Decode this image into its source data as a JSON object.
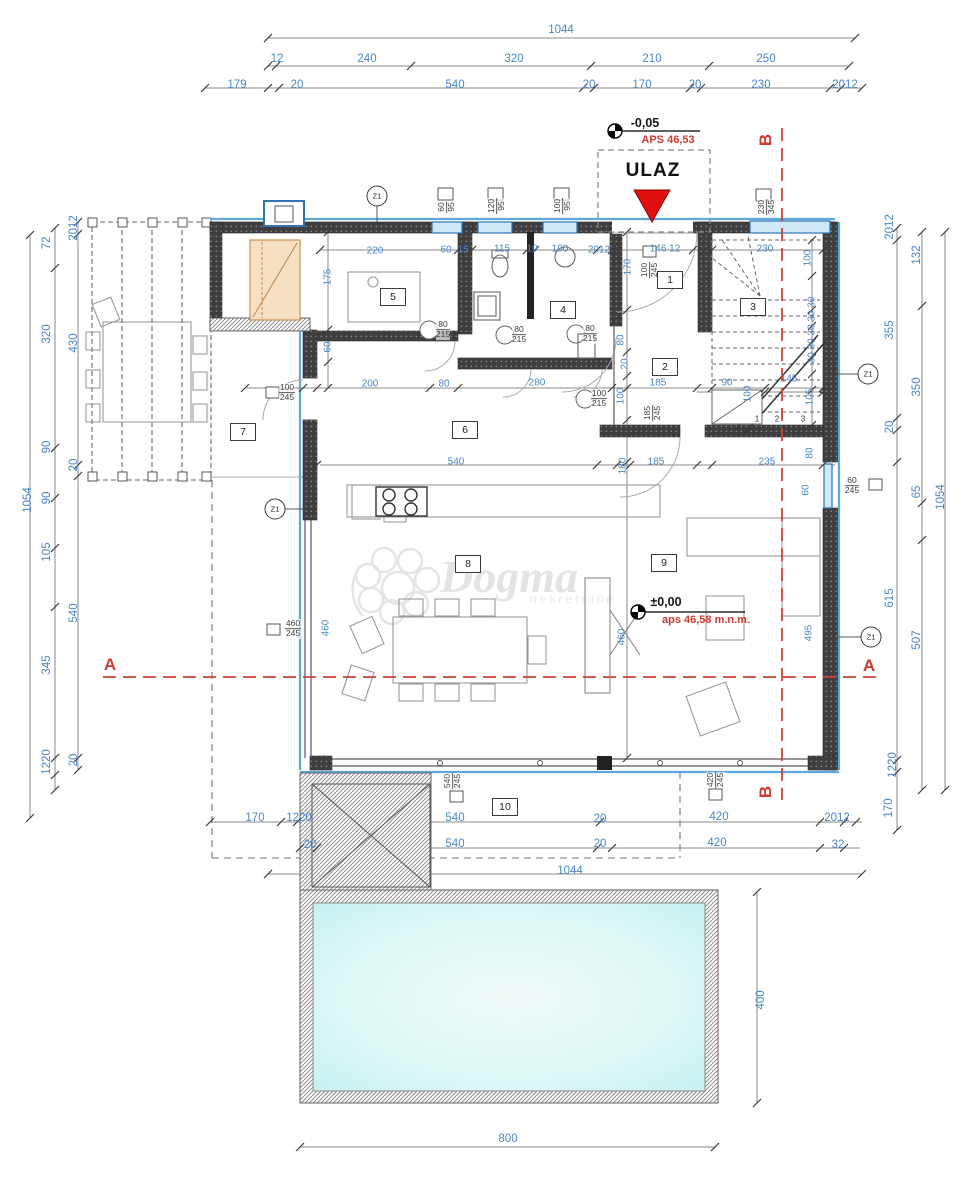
{
  "entrance": {
    "label": "ULAZ"
  },
  "watermark": {
    "name": "Dogma",
    "sub": "nekretnine"
  },
  "levels": {
    "entry_level": "-0,05",
    "entry_abs": "APS 46,53",
    "main_level": "±0,00",
    "main_abs": "aps 46,58 m.n.m."
  },
  "section_marks": [
    "A",
    "B"
  ],
  "colors": {
    "dim_blue": "#4a86c8",
    "accent_red": "#cf3a32",
    "glazing_blue": "#2e74b5",
    "pool_cyan": "#c4f2ef",
    "wood_tan": "#f6e0c2"
  },
  "rooms": [
    {
      "n": "1",
      "x": 670,
      "y": 280
    },
    {
      "n": "2",
      "x": 665,
      "y": 367
    },
    {
      "n": "3",
      "x": 753,
      "y": 307
    },
    {
      "n": "4",
      "x": 563,
      "y": 310
    },
    {
      "n": "5",
      "x": 393,
      "y": 297
    },
    {
      "n": "6",
      "x": 465,
      "y": 430
    },
    {
      "n": "7",
      "x": 243,
      "y": 432
    },
    {
      "n": "8",
      "x": 468,
      "y": 564
    },
    {
      "n": "9",
      "x": 664,
      "y": 563
    },
    {
      "n": "10",
      "x": 505,
      "y": 807
    }
  ],
  "zmarks": [
    {
      "t": "Z1",
      "x": 377,
      "y": 196
    },
    {
      "t": "Z1",
      "x": 275,
      "y": 509
    },
    {
      "t": "Z1",
      "x": 868,
      "y": 374
    },
    {
      "t": "Z1",
      "x": 871,
      "y": 637
    }
  ],
  "tags": [
    {
      "a": "60",
      "b": "95",
      "x": 447,
      "y": 207,
      "r": 1
    },
    {
      "a": "120",
      "b": "95",
      "x": 497,
      "y": 206,
      "r": 1
    },
    {
      "a": "100",
      "b": "95",
      "x": 563,
      "y": 206,
      "r": 1
    },
    {
      "a": "230",
      "b": "345",
      "x": 767,
      "y": 207,
      "r": 1
    },
    {
      "a": "100",
      "b": "245",
      "x": 650,
      "y": 270,
      "r": 1
    },
    {
      "a": "100",
      "b": "245",
      "x": 287,
      "y": 393
    },
    {
      "a": "80",
      "b": "215",
      "x": 443,
      "y": 330
    },
    {
      "a": "80",
      "b": "215",
      "x": 519,
      "y": 335
    },
    {
      "a": "80",
      "b": "215",
      "x": 590,
      "y": 334
    },
    {
      "a": "100",
      "b": "215",
      "x": 599,
      "y": 399
    },
    {
      "a": "185",
      "b": "245",
      "x": 653,
      "y": 413,
      "r": 1
    },
    {
      "a": "460",
      "b": "245",
      "x": 293,
      "y": 629
    },
    {
      "a": "60",
      "b": "245",
      "x": 852,
      "y": 486
    },
    {
      "a": "540",
      "b": "245",
      "x": 453,
      "y": 781,
      "r": 1
    },
    {
      "a": "420",
      "b": "245",
      "x": 716,
      "y": 780,
      "r": 1
    }
  ],
  "labels": [
    {
      "t": "1044",
      "x": 561,
      "y": 30,
      "c": "d"
    },
    {
      "t": "12",
      "x": 277,
      "y": 59,
      "c": "d"
    },
    {
      "t": "240",
      "x": 367,
      "y": 59,
      "c": "d"
    },
    {
      "t": "320",
      "x": 514,
      "y": 59,
      "c": "d"
    },
    {
      "t": "210",
      "x": 652,
      "y": 59,
      "c": "d"
    },
    {
      "t": "250",
      "x": 766,
      "y": 59,
      "c": "d"
    },
    {
      "t": "179",
      "x": 237,
      "y": 85,
      "c": "d"
    },
    {
      "t": "20",
      "x": 297,
      "y": 85,
      "c": "d"
    },
    {
      "t": "540",
      "x": 455,
      "y": 85,
      "c": "d"
    },
    {
      "t": "20",
      "x": 589,
      "y": 85,
      "c": "d"
    },
    {
      "t": "170",
      "x": 642,
      "y": 85,
      "c": "d"
    },
    {
      "t": "20",
      "x": 695,
      "y": 85,
      "c": "d"
    },
    {
      "t": "230",
      "x": 761,
      "y": 85,
      "c": "d"
    },
    {
      "t": "2012",
      "x": 845,
      "y": 85,
      "c": "d"
    },
    {
      "t": "1054",
      "x": 28,
      "y": 500,
      "c": "d",
      "r": 1
    },
    {
      "t": "72",
      "x": 47,
      "y": 243,
      "c": "d",
      "r": 1
    },
    {
      "t": "320",
      "x": 47,
      "y": 334,
      "c": "d",
      "r": 1
    },
    {
      "t": "90",
      "x": 47,
      "y": 447,
      "c": "d",
      "r": 1
    },
    {
      "t": "90",
      "x": 47,
      "y": 498,
      "c": "d",
      "r": 1
    },
    {
      "t": "105",
      "x": 47,
      "y": 552,
      "c": "d",
      "r": 1
    },
    {
      "t": "345",
      "x": 47,
      "y": 665,
      "c": "d",
      "r": 1
    },
    {
      "t": "1220",
      "x": 47,
      "y": 762,
      "c": "d",
      "r": 1
    },
    {
      "t": "2012",
      "x": 74,
      "y": 228,
      "c": "d",
      "r": 1
    },
    {
      "t": "430",
      "x": 74,
      "y": 343,
      "c": "d",
      "r": 1
    },
    {
      "t": "20",
      "x": 74,
      "y": 465,
      "c": "d",
      "r": 1
    },
    {
      "t": "540",
      "x": 74,
      "y": 613,
      "c": "d",
      "r": 1
    },
    {
      "t": "20",
      "x": 74,
      "y": 760,
      "c": "d",
      "r": 1
    },
    {
      "t": "2012",
      "x": 890,
      "y": 227,
      "c": "d",
      "r": 1
    },
    {
      "t": "355",
      "x": 890,
      "y": 330,
      "c": "d",
      "r": 1
    },
    {
      "t": "20",
      "x": 890,
      "y": 427,
      "c": "d",
      "r": 1
    },
    {
      "t": "615",
      "x": 890,
      "y": 598,
      "c": "d",
      "r": 1
    },
    {
      "t": "1220",
      "x": 893,
      "y": 765,
      "c": "d",
      "r": 1
    },
    {
      "t": "170",
      "x": 889,
      "y": 808,
      "c": "d",
      "r": 1
    },
    {
      "t": "132",
      "x": 917,
      "y": 255,
      "c": "d",
      "r": 1
    },
    {
      "t": "350",
      "x": 917,
      "y": 387,
      "c": "d",
      "r": 1
    },
    {
      "t": "65",
      "x": 917,
      "y": 492,
      "c": "d",
      "r": 1
    },
    {
      "t": "507",
      "x": 917,
      "y": 640,
      "c": "d",
      "r": 1
    },
    {
      "t": "1054",
      "x": 941,
      "y": 497,
      "c": "d",
      "r": 1
    },
    {
      "t": "170",
      "x": 255,
      "y": 818,
      "c": "d"
    },
    {
      "t": "1220",
      "x": 299,
      "y": 818,
      "c": "d"
    },
    {
      "t": "540",
      "x": 455,
      "y": 818,
      "c": "d"
    },
    {
      "t": "20",
      "x": 600,
      "y": 819,
      "c": "d"
    },
    {
      "t": "420",
      "x": 719,
      "y": 817,
      "c": "d"
    },
    {
      "t": "2012",
      "x": 837,
      "y": 818,
      "c": "d"
    },
    {
      "t": "20",
      "x": 310,
      "y": 845,
      "c": "d"
    },
    {
      "t": "540",
      "x": 455,
      "y": 844,
      "c": "d"
    },
    {
      "t": "20",
      "x": 600,
      "y": 844,
      "c": "d"
    },
    {
      "t": "420",
      "x": 717,
      "y": 843,
      "c": "d"
    },
    {
      "t": "32",
      "x": 838,
      "y": 845,
      "c": "d"
    },
    {
      "t": "1044",
      "x": 570,
      "y": 871,
      "c": "d"
    },
    {
      "t": "400",
      "x": 761,
      "y": 1000,
      "c": "d",
      "r": 1
    },
    {
      "t": "800",
      "x": 508,
      "y": 1139,
      "c": "d"
    },
    {
      "t": "220",
      "x": 375,
      "y": 251,
      "c": "s"
    },
    {
      "t": "60",
      "x": 446,
      "y": 250,
      "c": "s"
    },
    {
      "t": "15",
      "x": 463,
      "y": 250,
      "c": "s"
    },
    {
      "t": "115",
      "x": 502,
      "y": 249,
      "c": "s"
    },
    {
      "t": "10",
      "x": 532,
      "y": 249,
      "c": "s"
    },
    {
      "t": "100",
      "x": 560,
      "y": 249,
      "c": "s"
    },
    {
      "t": "2012",
      "x": 599,
      "y": 250,
      "c": "s"
    },
    {
      "t": "146 12",
      "x": 665,
      "y": 249,
      "c": "s"
    },
    {
      "t": "230",
      "x": 765,
      "y": 249,
      "c": "s"
    },
    {
      "t": "170",
      "x": 628,
      "y": 267,
      "c": "s",
      "r": 1
    },
    {
      "t": "80",
      "x": 621,
      "y": 340,
      "c": "s",
      "r": 1
    },
    {
      "t": "20",
      "x": 625,
      "y": 364,
      "c": "s",
      "r": 1
    },
    {
      "t": "100",
      "x": 621,
      "y": 396,
      "c": "s",
      "r": 1
    },
    {
      "t": "180",
      "x": 623,
      "y": 466,
      "c": "s",
      "r": 1
    },
    {
      "t": "175",
      "x": 328,
      "y": 277,
      "c": "s",
      "r": 1
    },
    {
      "t": "60",
      "x": 328,
      "y": 347,
      "c": "s",
      "r": 1
    },
    {
      "t": "200",
      "x": 370,
      "y": 384,
      "c": "s"
    },
    {
      "t": "80",
      "x": 444,
      "y": 384,
      "c": "s"
    },
    {
      "t": "280",
      "x": 537,
      "y": 383,
      "c": "s"
    },
    {
      "t": "185",
      "x": 658,
      "y": 383,
      "c": "s"
    },
    {
      "t": "90",
      "x": 727,
      "y": 383,
      "c": "s"
    },
    {
      "t": "145",
      "x": 789,
      "y": 379,
      "c": "s"
    },
    {
      "t": "540",
      "x": 456,
      "y": 462,
      "c": "s"
    },
    {
      "t": "185",
      "x": 656,
      "y": 462,
      "c": "s"
    },
    {
      "t": "235",
      "x": 767,
      "y": 462,
      "c": "s"
    },
    {
      "t": "100",
      "x": 808,
      "y": 258,
      "c": "s",
      "r": 1
    },
    {
      "t": "30 30 30 30 30",
      "x": 812,
      "y": 330,
      "c": "s",
      "r": 1
    },
    {
      "t": "100",
      "x": 748,
      "y": 394,
      "c": "s",
      "r": 1
    },
    {
      "t": "105",
      "x": 810,
      "y": 397,
      "c": "s",
      "r": 1
    },
    {
      "t": "80",
      "x": 810,
      "y": 453,
      "c": "s",
      "r": 1
    },
    {
      "t": "60",
      "x": 806,
      "y": 490,
      "c": "s",
      "r": 1
    },
    {
      "t": "460",
      "x": 326,
      "y": 628,
      "c": "s",
      "r": 1
    },
    {
      "t": "460",
      "x": 622,
      "y": 637,
      "c": "s",
      "r": 1
    },
    {
      "t": "495",
      "x": 809,
      "y": 633,
      "c": "s",
      "r": 1
    },
    {
      "t": "1",
      "x": 757,
      "y": 419,
      "c": "n"
    },
    {
      "t": "2",
      "x": 777,
      "y": 419,
      "c": "n"
    },
    {
      "t": "3",
      "x": 803,
      "y": 419,
      "c": "n"
    },
    {
      "t": "4",
      "x": 822,
      "y": 392,
      "c": "n"
    },
    {
      "t": "A",
      "x": 110,
      "y": 665,
      "c": "rl"
    },
    {
      "t": "A",
      "x": 869,
      "y": 666,
      "c": "rl"
    },
    {
      "t": "B",
      "x": 766,
      "y": 140,
      "c": "rl",
      "r": 1
    },
    {
      "t": "B",
      "x": 766,
      "y": 792,
      "c": "rl",
      "r": 1
    },
    {
      "t": "-0,05",
      "x": 645,
      "y": 123,
      "c": "bk"
    },
    {
      "t": "APS 46,53",
      "x": 668,
      "y": 140,
      "c": "rs"
    },
    {
      "t": "±0,00",
      "x": 666,
      "y": 602,
      "c": "bk"
    },
    {
      "t": "aps 46,58 m.n.m.",
      "x": 706,
      "y": 620,
      "c": "rs"
    }
  ]
}
